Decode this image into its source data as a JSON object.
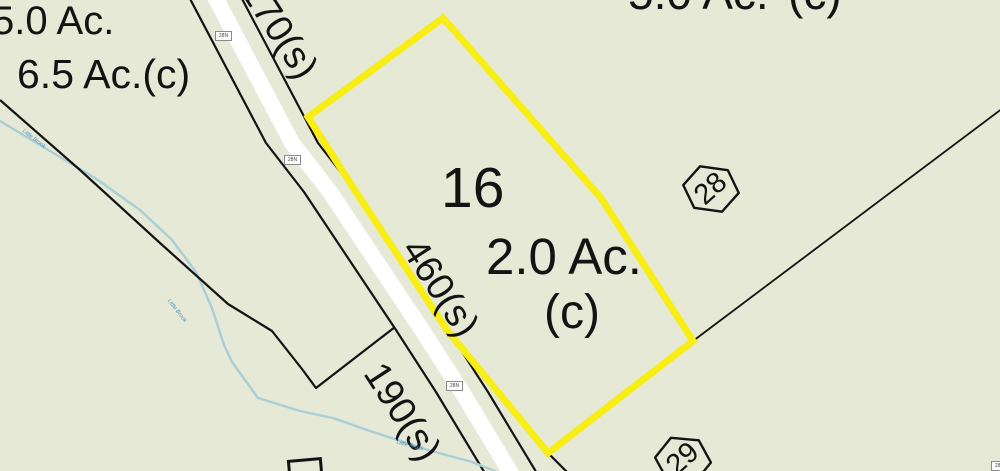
{
  "map": {
    "selected_parcel": {
      "lot_number": "16",
      "acreage": "2.0 Ac.",
      "acreage_suffix": "(c)"
    },
    "neighbor_labels": {
      "top_left_upper_acreage": "5.0 Ac.",
      "top_left_lower_acreage": "6.5 Ac.(c)",
      "top_right_cut_left_fragment": "5.0 Ac.",
      "top_right_cut_right_fragment": "(c)"
    },
    "hex_markers": [
      {
        "id": "28"
      },
      {
        "id": "29"
      }
    ],
    "dimensions": [
      {
        "label": "170(s)"
      },
      {
        "label": "460(s)"
      },
      {
        "label": "190(s)"
      }
    ],
    "road": {
      "route_markers": [
        {
          "label": "28N"
        },
        {
          "label": "28N"
        },
        {
          "label": "28N"
        },
        {
          "label": "28N"
        }
      ]
    },
    "stream": {
      "name": "Little Brook",
      "labels": [
        {
          "text": "Little Brook"
        },
        {
          "text": "Little Brook"
        },
        {
          "text": "Little Brook"
        }
      ]
    },
    "colors": {
      "bg": "#E5E9D5",
      "ink": "#131313",
      "yellow": "#F8EE16",
      "road-white": "#FFFFFF",
      "stream": "#A9CED6",
      "stream-text": "#4E93BA"
    }
  }
}
